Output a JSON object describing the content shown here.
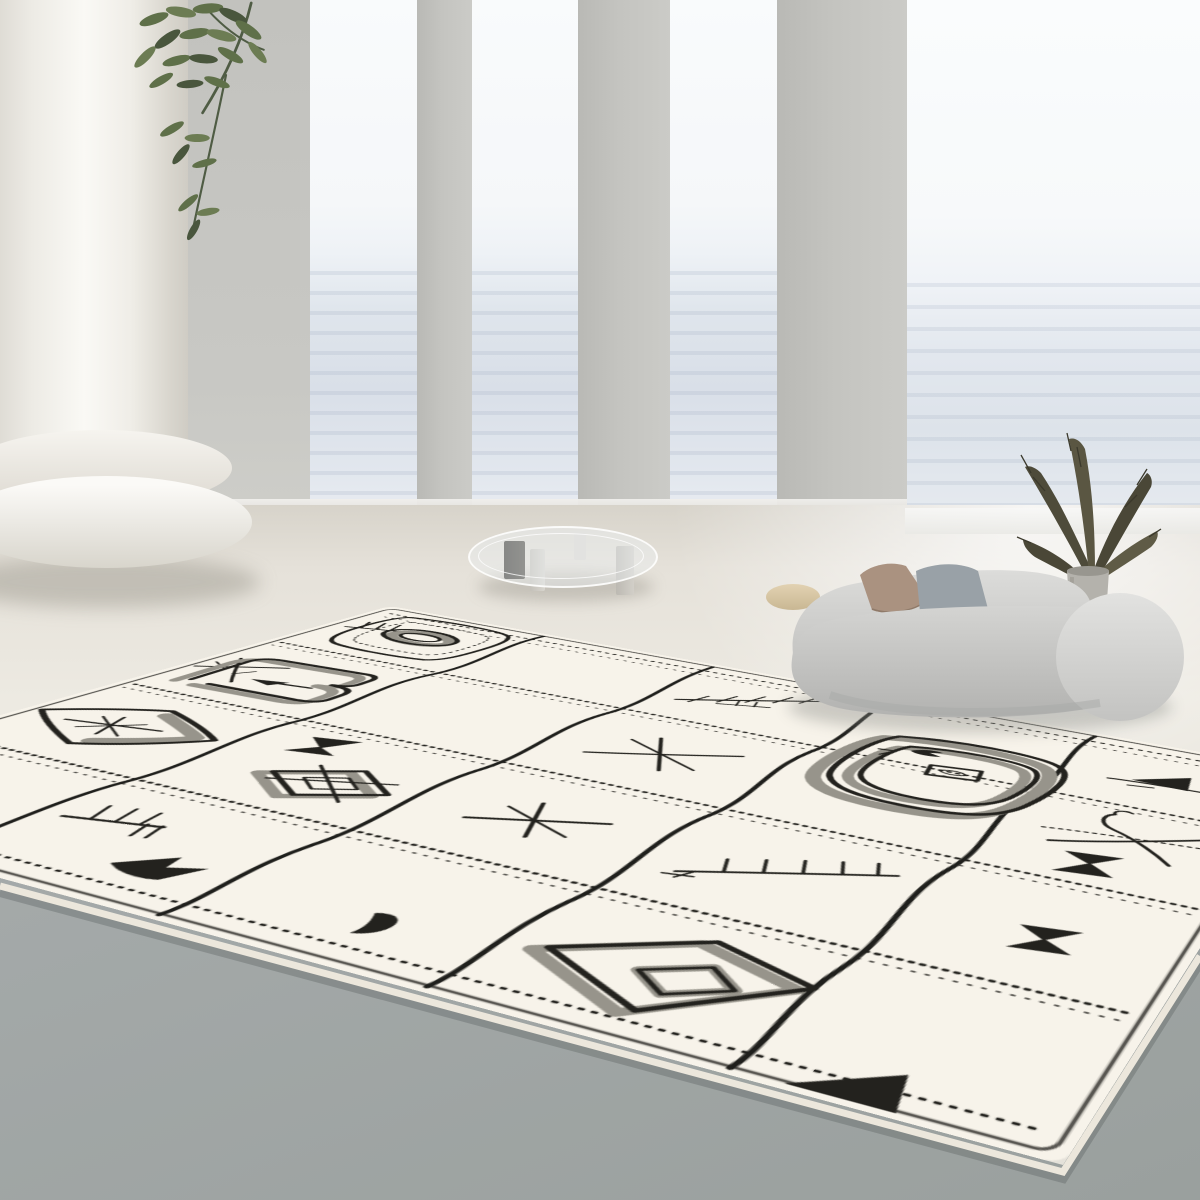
{
  "meta": {
    "title": "Minimalist seaside living room with Berber rug",
    "description": "Bright minimalist interior: white classical column and gray pillars framing floor-to-ceiling sea views, a green plant branch, a round glass coffee table on stone block legs, a curved light-gray organic sofa with a tan and a gray cushion, a dried pampas arrangement in a gray vase, and a large cream Moroccan Berber-style rug with black hand-drawn geometric motifs lying over a two-tone cream and gray floor."
  },
  "palette": {
    "wall": "#c6c6c2",
    "pillar": "#c2c2bf",
    "sky": "#f9fbfc",
    "sea": "#dde3ea",
    "floor_far": "#e9e6de",
    "floor_near": "#a6abab",
    "column": "#f4f2ec",
    "sofa_body": "#c9c9c7",
    "pillow_tan": "#aa9280",
    "pillow_gray": "#99a1a7",
    "plant_green": "#5f7049",
    "pampas_brown": "#4e4b3a",
    "vase_gray": "#b4b2ac",
    "rug_base": "#f7f3ea",
    "rug_line": "#23221e",
    "rug_shadow": "#97948b"
  },
  "scene": {
    "objects": [
      {
        "name": "classical-column",
        "color": "#f4f2ec"
      },
      {
        "name": "gray-pillars",
        "count": 3,
        "color": "#c2c2bf"
      },
      {
        "name": "sea-view-windows",
        "count": 4,
        "color": "#e8edf2"
      },
      {
        "name": "green-plant-branch",
        "color": "#5f7049"
      },
      {
        "name": "glass-coffee-table",
        "color": "#eaeff1"
      },
      {
        "name": "curved-sofa",
        "color": "#c9c9c7"
      },
      {
        "name": "tan-pillow",
        "color": "#aa9280"
      },
      {
        "name": "gray-pillow",
        "color": "#99a1a7"
      },
      {
        "name": "pampas-plant",
        "color": "#4e4b3a"
      },
      {
        "name": "gray-vase",
        "color": "#b4b2ac"
      },
      {
        "name": "beige-side-table",
        "color": "#d5c3a0"
      },
      {
        "name": "berber-rug",
        "color": "#f7f3ea"
      }
    ]
  },
  "rug": {
    "base_color": "#f7f3ea",
    "line_color": "#23221e",
    "shadow_color": "#97948b",
    "grid": {
      "columns": 5,
      "rows": 4,
      "column_dividers": "wavy solid lines",
      "row_dividers": "dotted stitch lines"
    },
    "motifs": [
      "trident-twig",
      "rounded-square-with-oval-ring",
      "fishbone-branch",
      "large-concentric-rounded-squares",
      "black-triangle-pair",
      "crossed-lines",
      "squiggle-rectangle-with-arrow",
      "asterisk-star",
      "curve-cross",
      "bowtie",
      "diamond-eye-with-asterisk",
      "diamond-with-x",
      "large-fishbone",
      "trident-and-flag",
      "comma",
      "diamond-in-diamond",
      "corner-triangle"
    ]
  }
}
